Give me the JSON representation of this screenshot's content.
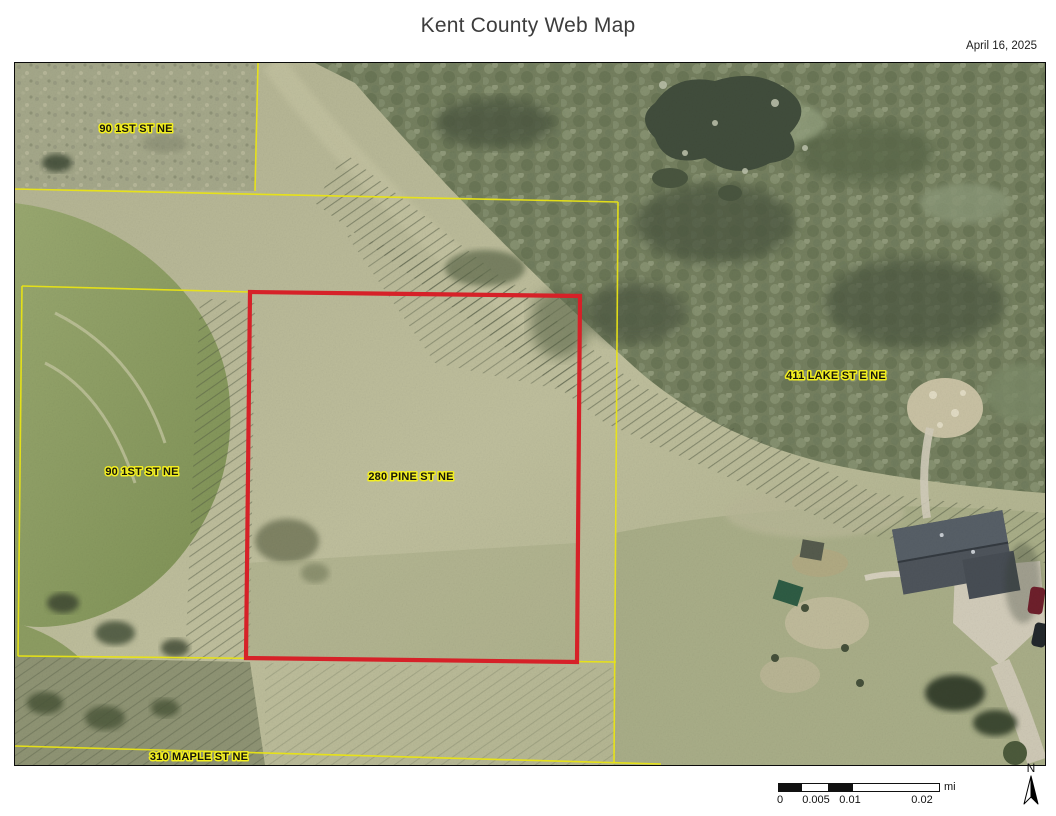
{
  "header": {
    "title": "Kent County Web Map",
    "date": "April 16, 2025"
  },
  "map": {
    "parcel_labels": [
      {
        "text": "90 1ST ST NE",
        "x": 121,
        "y": 69
      },
      {
        "text": "90 1ST ST NE",
        "x": 127,
        "y": 412
      },
      {
        "text": "280 PINE ST NE",
        "x": 396,
        "y": 417
      },
      {
        "text": "411 LAKE ST E NE",
        "x": 821,
        "y": 316
      },
      {
        "text": "310 MAPLE ST NE",
        "x": 184,
        "y": 697
      }
    ],
    "highlight_color": "#d62128",
    "boundary_color": "#e9e414"
  },
  "scale_bar": {
    "ticks": [
      "0",
      "0.005",
      "0.01",
      "0.02"
    ],
    "unit": "mi"
  },
  "north_arrow": {
    "label": "N"
  }
}
